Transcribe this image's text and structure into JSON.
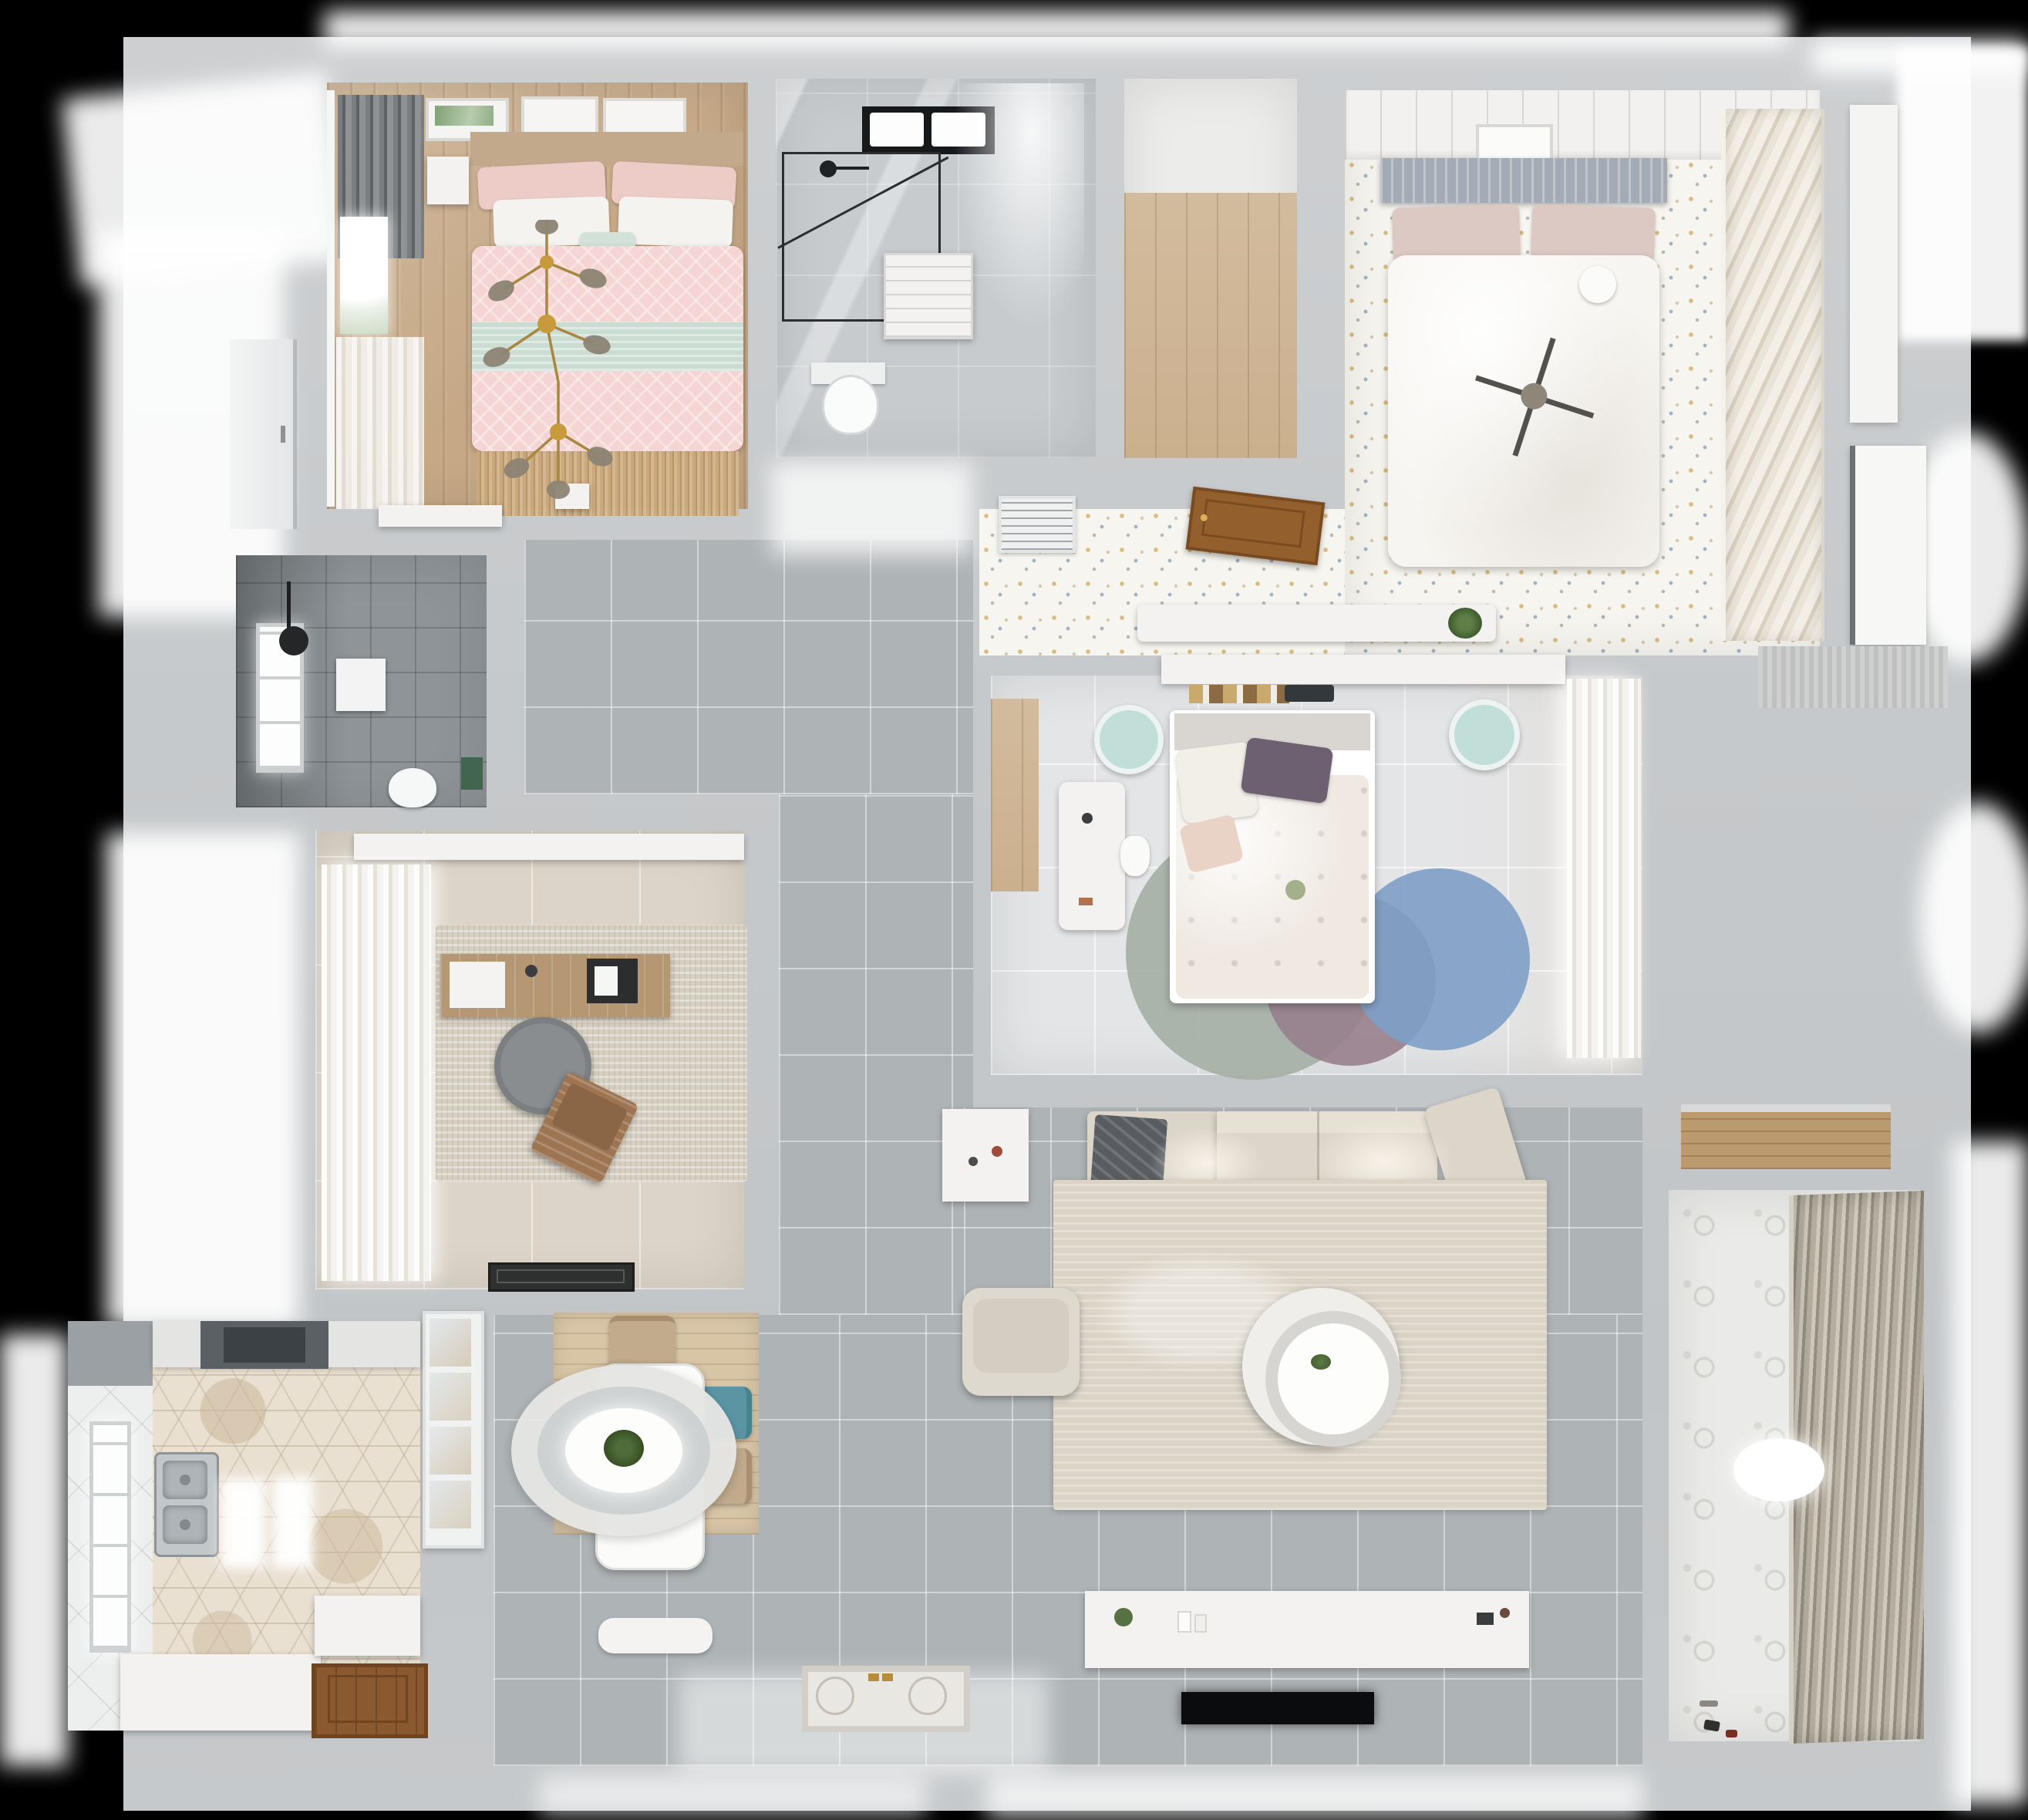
{
  "meta": {
    "image_type": "3d-floor-plan-render",
    "view": "top-down dollhouse",
    "visible_text": "none",
    "background": "#000000"
  },
  "palette": {
    "wall_gray": "#c6c9cb",
    "corridor_tile": "#aeb3b6",
    "wood_tan": "#c5a886",
    "closet_plank": "#cbb08e",
    "pink_bedding": "#f4d5d3",
    "mint_accent": "#cbdcd2",
    "gold_fixture": "#a8873e",
    "dark_bath_tile": "#8e9497",
    "confetti_floor": "#f7f5ef",
    "hex_tile": "#e9e0d2",
    "teal_chair": "#5b95a4",
    "sage_rug": "#a6b0a6",
    "mauve_rug": "#97808c",
    "blue_rug": "#7e9ec7",
    "sofa_beige": "#dcd5c9",
    "blanket_gray": "#595d61",
    "entry_door_wood": "#8a5930",
    "tv_black": "#0b0c0d"
  },
  "rooms": [
    {
      "id": "bedroom-master",
      "label": "Master bedroom with pink bedding, gold branch chandelier, art frames and window curtains",
      "furniture": [
        "double-bed",
        "pink-duvet",
        "mint-throw",
        "pillows",
        "nightstand",
        "bench",
        "wall-art-frames",
        "window",
        "curtain"
      ]
    },
    {
      "id": "bathroom-main",
      "label": "Main bathroom with glass shower, skylight, vanity cabinet and toilet",
      "furniture": [
        "shower-enclosure",
        "shower-head",
        "skylight",
        "vanity-cabinet",
        "toilet"
      ]
    },
    {
      "id": "storage-closet",
      "label": "Storage closet with wood plank floor",
      "furniture": []
    },
    {
      "id": "bedroom-guest",
      "label": "Guest bedroom with white bed, slatted wardrobe, confetti floor, console and open wood door",
      "furniture": [
        "double-bed",
        "gray-headboard",
        "round-pillow",
        "ceiling-light-cross",
        "slatted-wardrobe",
        "art-frame",
        "console-shelf",
        "plant",
        "open-wood-door",
        "air-vent"
      ]
    },
    {
      "id": "bathroom-shower",
      "label": "Dark tiled shower room with window, wall niche, toilet and green towel",
      "furniture": [
        "window",
        "shower-head",
        "wall-niche",
        "toilet",
        "green-towel"
      ]
    },
    {
      "id": "home-office",
      "label": "Home office with desk, laptop, round chair, wooden lounge chair, rug and curtains",
      "furniture": [
        "curtains",
        "shelf",
        "desk",
        "laptop",
        "desk-chair",
        "lounge-chair",
        "area-rug",
        "doormat"
      ]
    },
    {
      "id": "bedroom-second",
      "label": "Second bedroom with bed, headboard shelf with books, bedside stools, desk and circle rug",
      "furniture": [
        "bed",
        "headboard-shelf",
        "books",
        "tablet",
        "bedside-stool-left",
        "bedside-stool-right",
        "desk",
        "desk-chair",
        "circle-rug-sage",
        "circle-rug-mauve",
        "circle-rug-blue",
        "curtains",
        "wood-floor-strip"
      ]
    },
    {
      "id": "living-room",
      "label": "Living room with sectional sofa, throw blanket, round coffee table, armchair, side table, TV console and TV",
      "furniture": [
        "sectional-sofa",
        "throw-blanket",
        "area-rug",
        "round-coffee-table",
        "armchair",
        "side-table",
        "tv-console",
        "tv"
      ]
    },
    {
      "id": "dining-area",
      "label": "Dining area with white table, ring pendant lamp, plant centerpiece, chairs and glass cabinet",
      "furniture": [
        "dining-table",
        "pendant-lamp",
        "plant-centerpiece",
        "chair-top",
        "chair-teal",
        "chair-tan",
        "bench",
        "chair-bottom",
        "glass-cabinet",
        "plank-rug"
      ]
    },
    {
      "id": "kitchen",
      "label": "Kitchen with hexagon tile floor, range hood, double sink, counters, window and wood door",
      "furniture": [
        "range-hood",
        "upper-cabinets",
        "double-sink",
        "ceiling-light-left",
        "ceiling-light-right",
        "counter-bottom",
        "counter-right",
        "wood-door",
        "window"
      ]
    },
    {
      "id": "hallway",
      "label": "Hallway and entry with gray tile floor and decorative doormat",
      "furniture": [
        "entry-doormat"
      ]
    },
    {
      "id": "balcony",
      "label": "Balcony laundry room with patterned tile, roller blinds, ceiling light and toys",
      "furniture": [
        "roller-blinds",
        "ceiling-light",
        "wood-shelf",
        "toys"
      ]
    }
  ]
}
